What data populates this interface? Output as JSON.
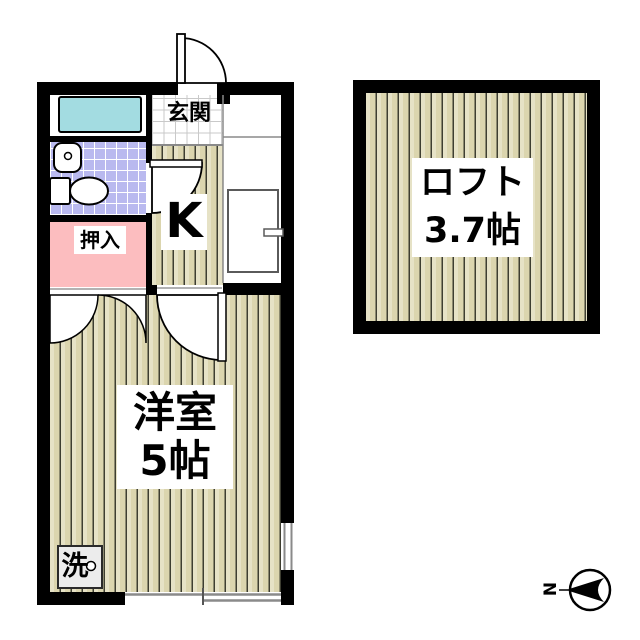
{
  "floor_plan": {
    "rooms": {
      "entrance": {
        "label": "玄関"
      },
      "kitchen": {
        "label": "K"
      },
      "closet": {
        "label": "押入"
      },
      "western_room": {
        "name": "洋室",
        "size": "5帖"
      },
      "loft": {
        "name": "ロフト",
        "size": "3.7帖"
      },
      "laundry": {
        "label": "洗"
      }
    },
    "compass": {
      "north_label": "N"
    },
    "fixtures": [
      "bathtub",
      "sink",
      "toilet",
      "washing-machine-pan",
      "refrigerator"
    ],
    "colors": {
      "wall": "#000000",
      "bathtub_fill": "#a3dce1",
      "toilet_tile": "#b9b9ef",
      "closet_fill": "#fcbdbf",
      "wood_floor": "#dbd5ae",
      "laundry_pan_fill": "#ececec",
      "window_line": "#8a8a8a"
    }
  }
}
